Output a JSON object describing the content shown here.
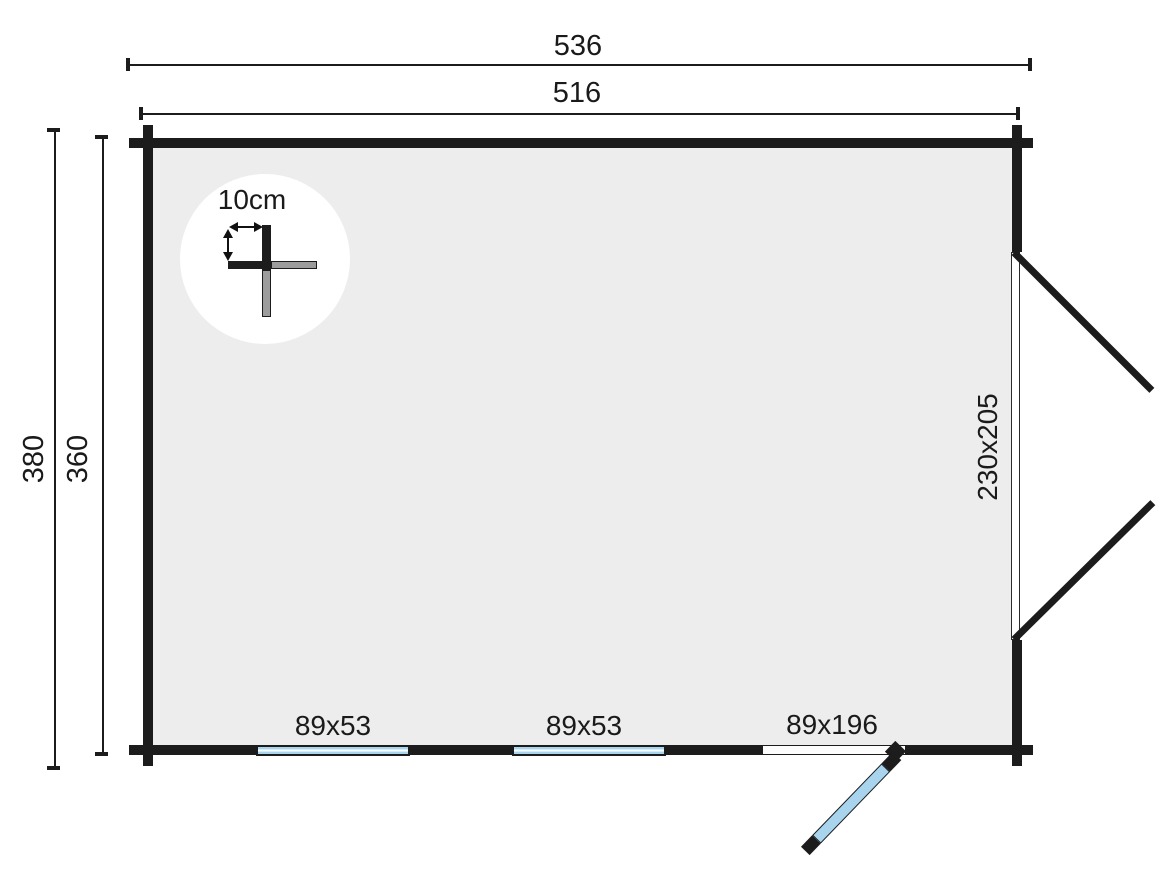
{
  "detail": {
    "label": "10cm"
  },
  "dimensions": {
    "outer_width": "536",
    "inner_width": "516",
    "outer_height": "380",
    "inner_height": "360"
  },
  "openings": {
    "double_door": {
      "size": "230x205"
    },
    "window_left": {
      "size": "89x53"
    },
    "window_middle": {
      "size": "89x53"
    },
    "front_door": {
      "size": "89x196"
    }
  },
  "colors": {
    "wall": "#1c1c1c",
    "floor": "#ededee",
    "glass": "#a9d4ee",
    "detail_gray": "#9c9c9c",
    "background": "#ffffff"
  }
}
